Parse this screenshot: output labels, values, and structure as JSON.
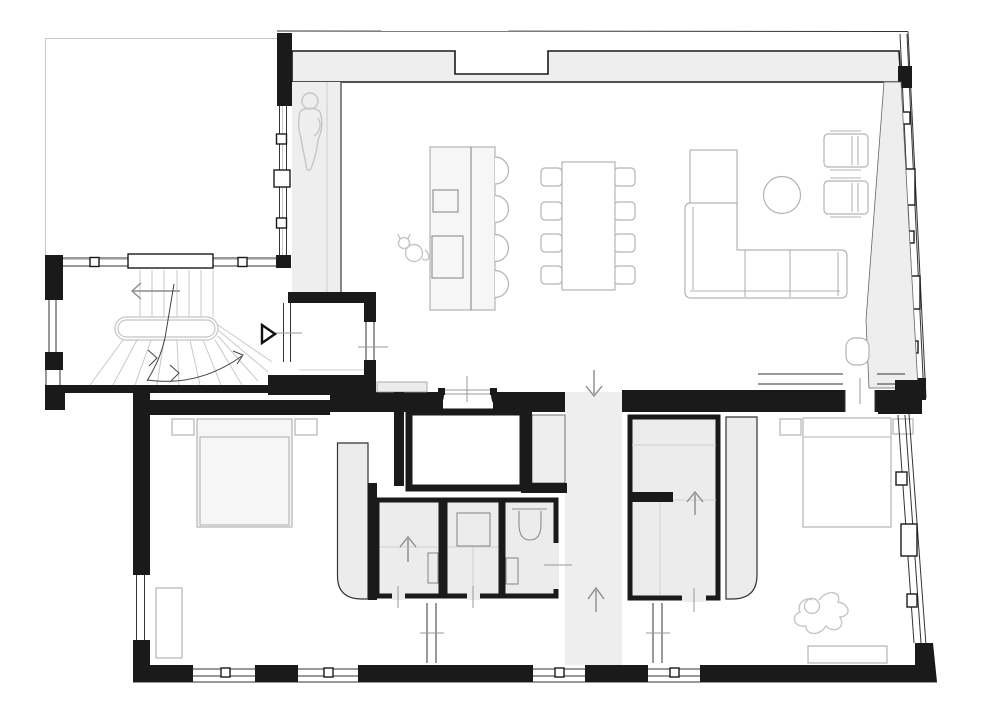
{
  "canvas": {
    "width": 1000,
    "height": 718
  },
  "palette": {
    "wall": "#1a1a1a",
    "poche": "#eeeeee",
    "poche2": "#ececec",
    "furn": "#b3b3b3",
    "fig": "#c6c6c6",
    "stair": "#c9c9c9",
    "arrow": "#8c8c8c",
    "tick": "#9a9a9a",
    "terrace": "#c8c8c8",
    "bg": "#ffffff"
  },
  "plan": {
    "drawing_type": "apartment floor plan, top view, line drawing, no text labels",
    "rooms": [
      {
        "name": "terrace-court"
      },
      {
        "name": "living-dining-kitchen"
      },
      {
        "name": "stairwell"
      },
      {
        "name": "entry-vestibule"
      },
      {
        "name": "storage-room"
      },
      {
        "name": "hallway"
      },
      {
        "name": "shower-room"
      },
      {
        "name": "utility-room"
      },
      {
        "name": "wc"
      },
      {
        "name": "ensuite-bathroom"
      },
      {
        "name": "bedroom-left"
      },
      {
        "name": "bedroom-right"
      }
    ],
    "furniture": [
      {
        "name": "kitchen-island",
        "count": 1
      },
      {
        "name": "bar-stool",
        "count": 4
      },
      {
        "name": "dining-table",
        "count": 1
      },
      {
        "name": "dining-chair",
        "count": 8
      },
      {
        "name": "corner-sofa",
        "count": 1
      },
      {
        "name": "chaise-extension",
        "count": 1
      },
      {
        "name": "coffee-table-round",
        "count": 1
      },
      {
        "name": "armchair",
        "count": 2
      },
      {
        "name": "desk-chair",
        "count": 1
      },
      {
        "name": "double-bed",
        "count": 2
      },
      {
        "name": "nightstand",
        "count": 4
      },
      {
        "name": "built-in-wardrobe-curved",
        "count": 2
      },
      {
        "name": "dresser",
        "count": 2
      },
      {
        "name": "toilet",
        "count": 1
      },
      {
        "name": "washbasin",
        "count": 1
      },
      {
        "name": "washing-machine",
        "count": 1
      },
      {
        "name": "shower-bench",
        "count": 1
      }
    ],
    "symbols": [
      {
        "name": "entrance-triangle-marker"
      },
      {
        "name": "stair-direction-arrow-left"
      },
      {
        "name": "stair-walk-line-arrow"
      },
      {
        "name": "hallway-arrow-down"
      },
      {
        "name": "hallway-arrow-up"
      },
      {
        "name": "shower-slope-arrow",
        "count": 2
      },
      {
        "name": "door-threshold-tick",
        "count": 10
      },
      {
        "name": "window-mullion",
        "count": 12
      }
    ],
    "figures": [
      {
        "name": "person-standing-top-view",
        "location": "living-room-entry-strip"
      },
      {
        "name": "cat-top-view",
        "location": "kitchen"
      },
      {
        "name": "person-lying-top-view",
        "location": "bedroom-right"
      }
    ]
  }
}
